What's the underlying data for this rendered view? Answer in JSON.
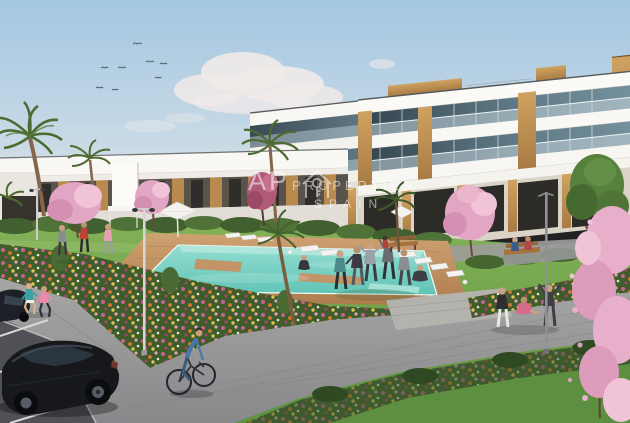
{
  "meta": {
    "description": "Photorealistic architectural render of a Mediterranean apartment complex with communal pool, gardens, parking and people exercising",
    "image_type": "architectural-render"
  },
  "watermark": {
    "brand_prefix": "AP",
    "brand_name": "PROPERTIES",
    "brand_sub": "SPAIN",
    "icon": "house-key-logo-icon",
    "color": "#ffffff"
  },
  "palette": {
    "sky_top": "#a3c6e1",
    "sky_horizon": "#e6e3df",
    "cloud": "#f1eae9",
    "building_white": "#f9f8f4",
    "wood_accent": "#bd8d4f",
    "glass_dark": "#33434d",
    "lawn_green": "#76a74d",
    "pool_water": "#6ecabb",
    "deck_wood": "#c2946a",
    "flower_magenta": "#cf5f9b",
    "flower_orange": "#de7b33",
    "blossom_pink": "#e7afc9",
    "path_gray": "#98989a",
    "asphalt": "#505156",
    "car_body": "#16181c",
    "hedge_green": "#41602f"
  },
  "scene": {
    "elements": [
      "sky",
      "birds",
      "clouds",
      "apartment-block-right",
      "apartment-row-left",
      "palm-trees",
      "cherry-blossom-trees",
      "hedges",
      "lawn",
      "flower-beds",
      "swimming-pool",
      "pool-deck",
      "sun-loungers",
      "parasols",
      "walkway",
      "parking-area",
      "black-car",
      "cyclist",
      "joggers",
      "people-exercising",
      "park-benches",
      "street-lamps"
    ]
  }
}
